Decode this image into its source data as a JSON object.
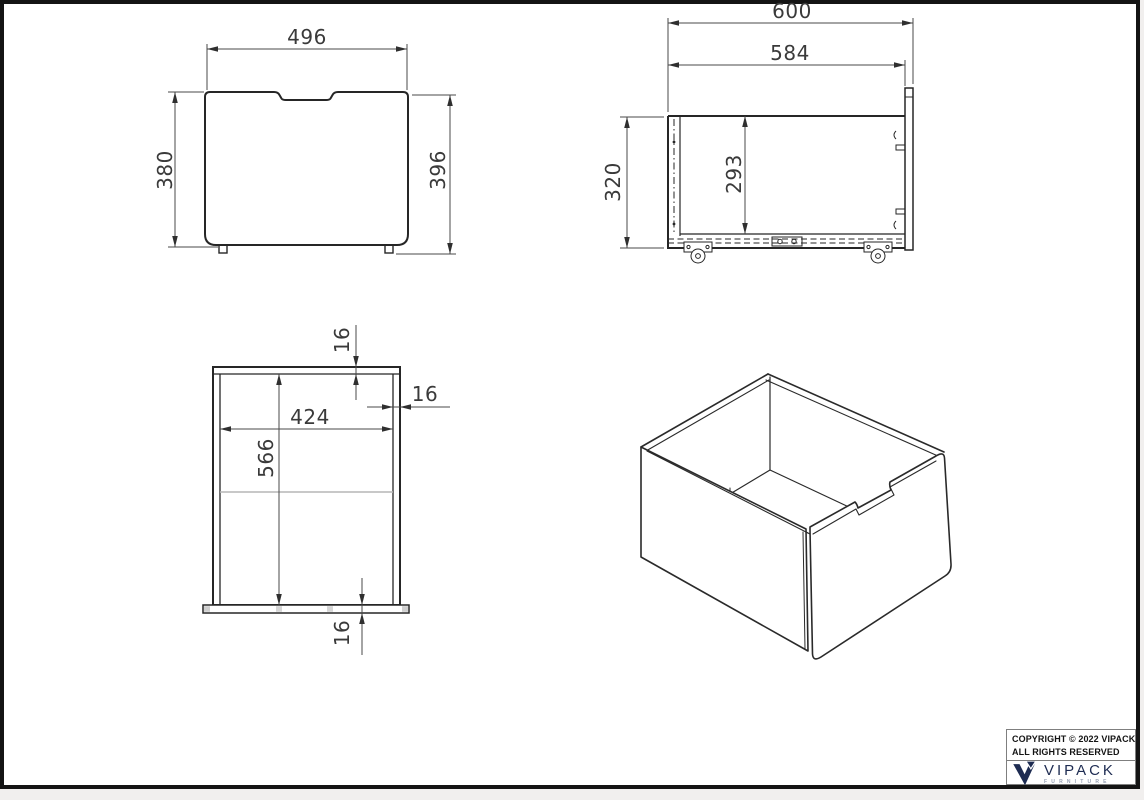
{
  "front_view": {
    "width": "496",
    "height_left": "380",
    "height_right": "396"
  },
  "side_view": {
    "width_outer": "600",
    "width_inner": "584",
    "height_outer": "320",
    "height_inner": "293"
  },
  "top_view": {
    "rear_wall_thickness": "16",
    "side_wall_thickness": "16",
    "inner_width": "424",
    "inner_depth": "566",
    "front_panel_thickness": "16"
  },
  "title_block": {
    "copyright_line1": "COPYRIGHT © 2022 VIPACK,",
    "copyright_line2": "ALL RIGHTS RESERVED",
    "brand": "VIPACK",
    "brand_tagline": "FURNITURE"
  },
  "colors": {
    "object_line": "#262626",
    "dimension_line": "#4a4a4a",
    "brand_navy": "#1e2c52",
    "background": "#ffffff",
    "frame": "#141414"
  }
}
